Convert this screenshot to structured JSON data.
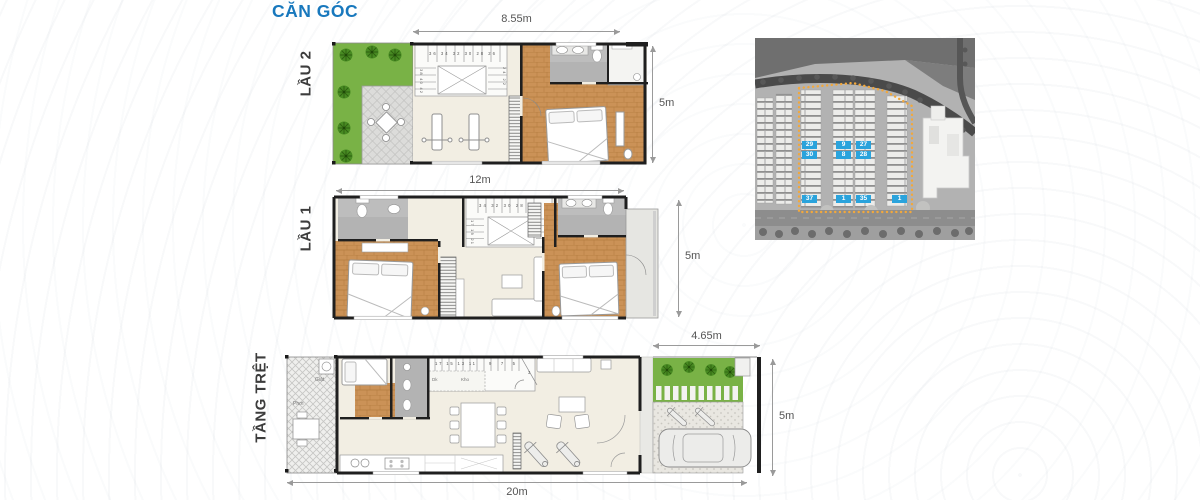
{
  "title": "CĂN GÓC",
  "colors": {
    "accent": "#1878bd",
    "map_unit_bg": "#2aa3dc",
    "map_outline": "#f2a83c",
    "wood_floor": "#cb9257",
    "garden_green": "#79b246"
  },
  "floors": [
    {
      "id": "lau2",
      "label": "LẦU 2",
      "dim_top": "8.55m",
      "dim_right": "5m",
      "stairs_top": "36 34 32 30 28 26",
      "stairs_left": "38 40 42",
      "stairs_right": "24 22"
    },
    {
      "id": "lau1",
      "label": "LẦU 1",
      "dim_top": "12m",
      "dim_right": "5m",
      "stairs_top": "34 32 30 28 26",
      "stairs_left": "17 19 21",
      "stairs_right": "24 22"
    },
    {
      "id": "tang-tret",
      "label": "TẦNG TRỆT",
      "dim_top": "4.65m",
      "dim_right": "5m",
      "dim_bottom": "20m",
      "stairs_left_run": "17 15 13 11",
      "stairs_right_run": "9 7 5",
      "stairs_corner": "3",
      "labels": {
        "wash": "Giặt",
        "dry": "Phơi",
        "storage": "Kho",
        "dk": "Dk"
      }
    }
  ],
  "site_map": {
    "units": [
      "29",
      "30",
      "37",
      "9",
      "8",
      "1",
      "27",
      "28",
      "35",
      "1"
    ]
  }
}
